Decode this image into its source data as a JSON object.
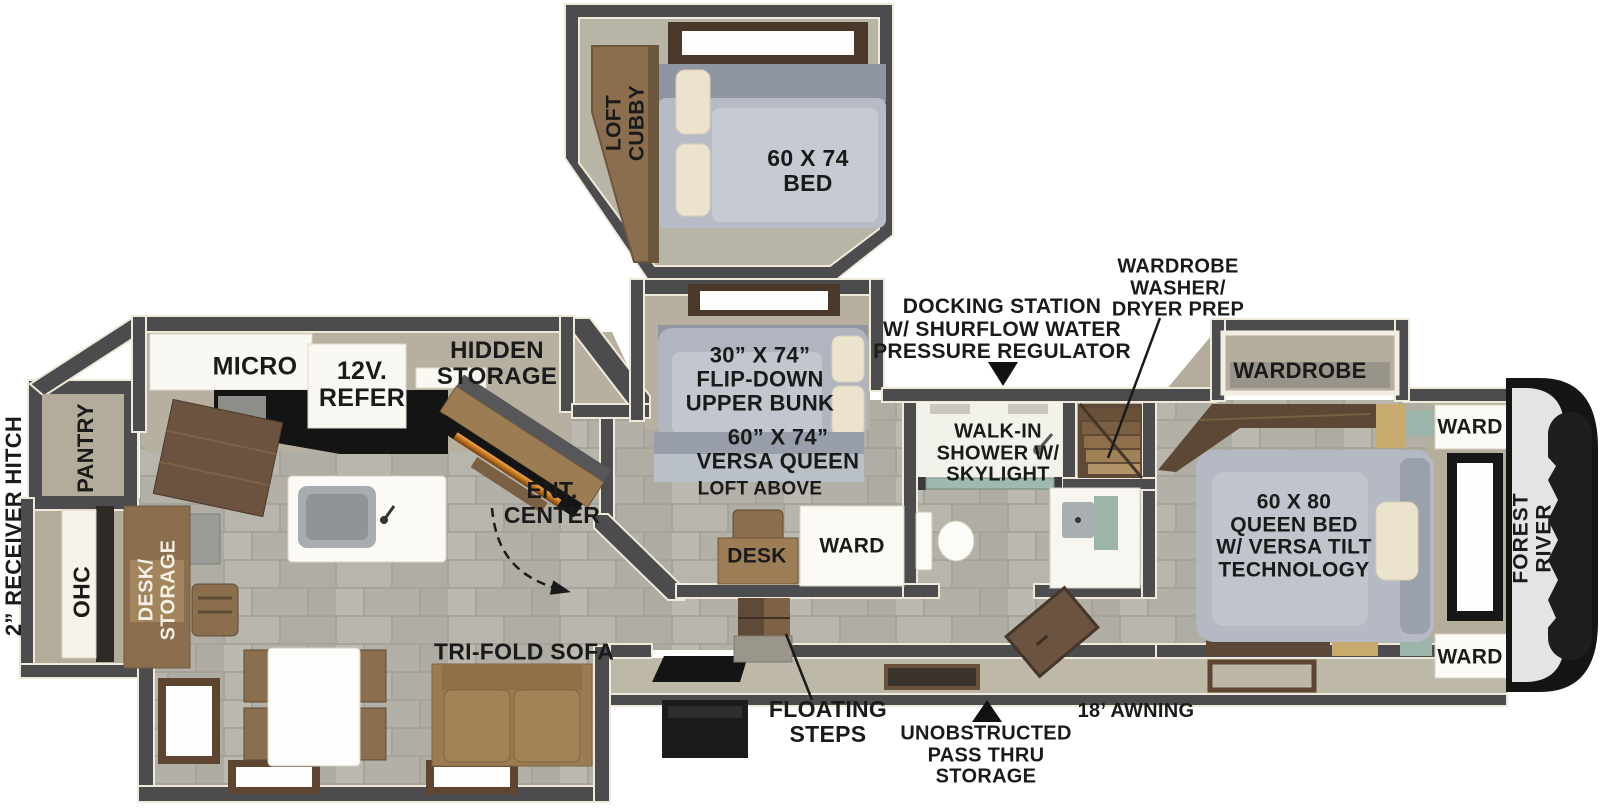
{
  "floorplan": {
    "brand": "FOREST RIVER",
    "labels": {
      "loft_cubby": "LOFT\nCUBBY",
      "loft_bed": "60 X 74\nBED",
      "micro": "MICRO",
      "refer": "12V.\nREFER",
      "hidden_storage": "HIDDEN\nSTORAGE",
      "pantry": "PANTRY",
      "receiver_hitch": "2” RECEIVER HITCH",
      "ohc": "OHC",
      "desk_storage": "DESK/\nSTORAGE",
      "ent_center": "ENT.\nCENTER",
      "tri_fold_sofa": "TRI-FOLD SOFA",
      "flip_down_bunk": "30” X 74”\nFLIP-DOWN\nUPPER BUNK",
      "versa_queen": "60” X 74”\nVERSA QUEEN",
      "loft_above": "LOFT ABOVE",
      "desk": "DESK",
      "ward_bunk": "WARD",
      "docking_station": "DOCKING STATION\nW/ SHURFLOW WATER\nPRESSURE REGULATOR",
      "walk_in_shower": "WALK-IN\nSHOWER W/\nSKYLIGHT",
      "wardrobe_prep": "WARDROBE\nWASHER/\nDRYER PREP",
      "wardrobe": "WARDROBE",
      "ward_top": "WARD",
      "ward_bottom": "WARD",
      "queen_bed": "60 X 80\nQUEEN BED\nW/ VERSA TILT\nTECHNOLOGY",
      "forest_river": "FOREST RIVER",
      "floating_steps": "FLOATING\nSTEPS",
      "pass_thru": "UNOBSTRUCTED\nPASS THRU\nSTORAGE",
      "awning": "18’ AWNING"
    },
    "icons": {
      "docking_station_pointer": "down-triangle",
      "pass_thru_pointer": "up-triangle",
      "entry_path": "dashed-curved-arrow"
    },
    "colors": {
      "wall": "#4c4c4e",
      "wall_outline": "#efe9da",
      "tile_floor": "#b4b1a8",
      "slide_floor": "#b7b0a0",
      "wood_dark": "#5f4a38",
      "wood_mid": "#8a6e4e",
      "bed_gray": "#b4b9c3",
      "pillow": "#ebe3cd",
      "sofa": "#a28356",
      "teal_accent": "#9db4aa",
      "fireplace_glow": "#e98f2e",
      "label_text": "#1a1a1a"
    }
  }
}
